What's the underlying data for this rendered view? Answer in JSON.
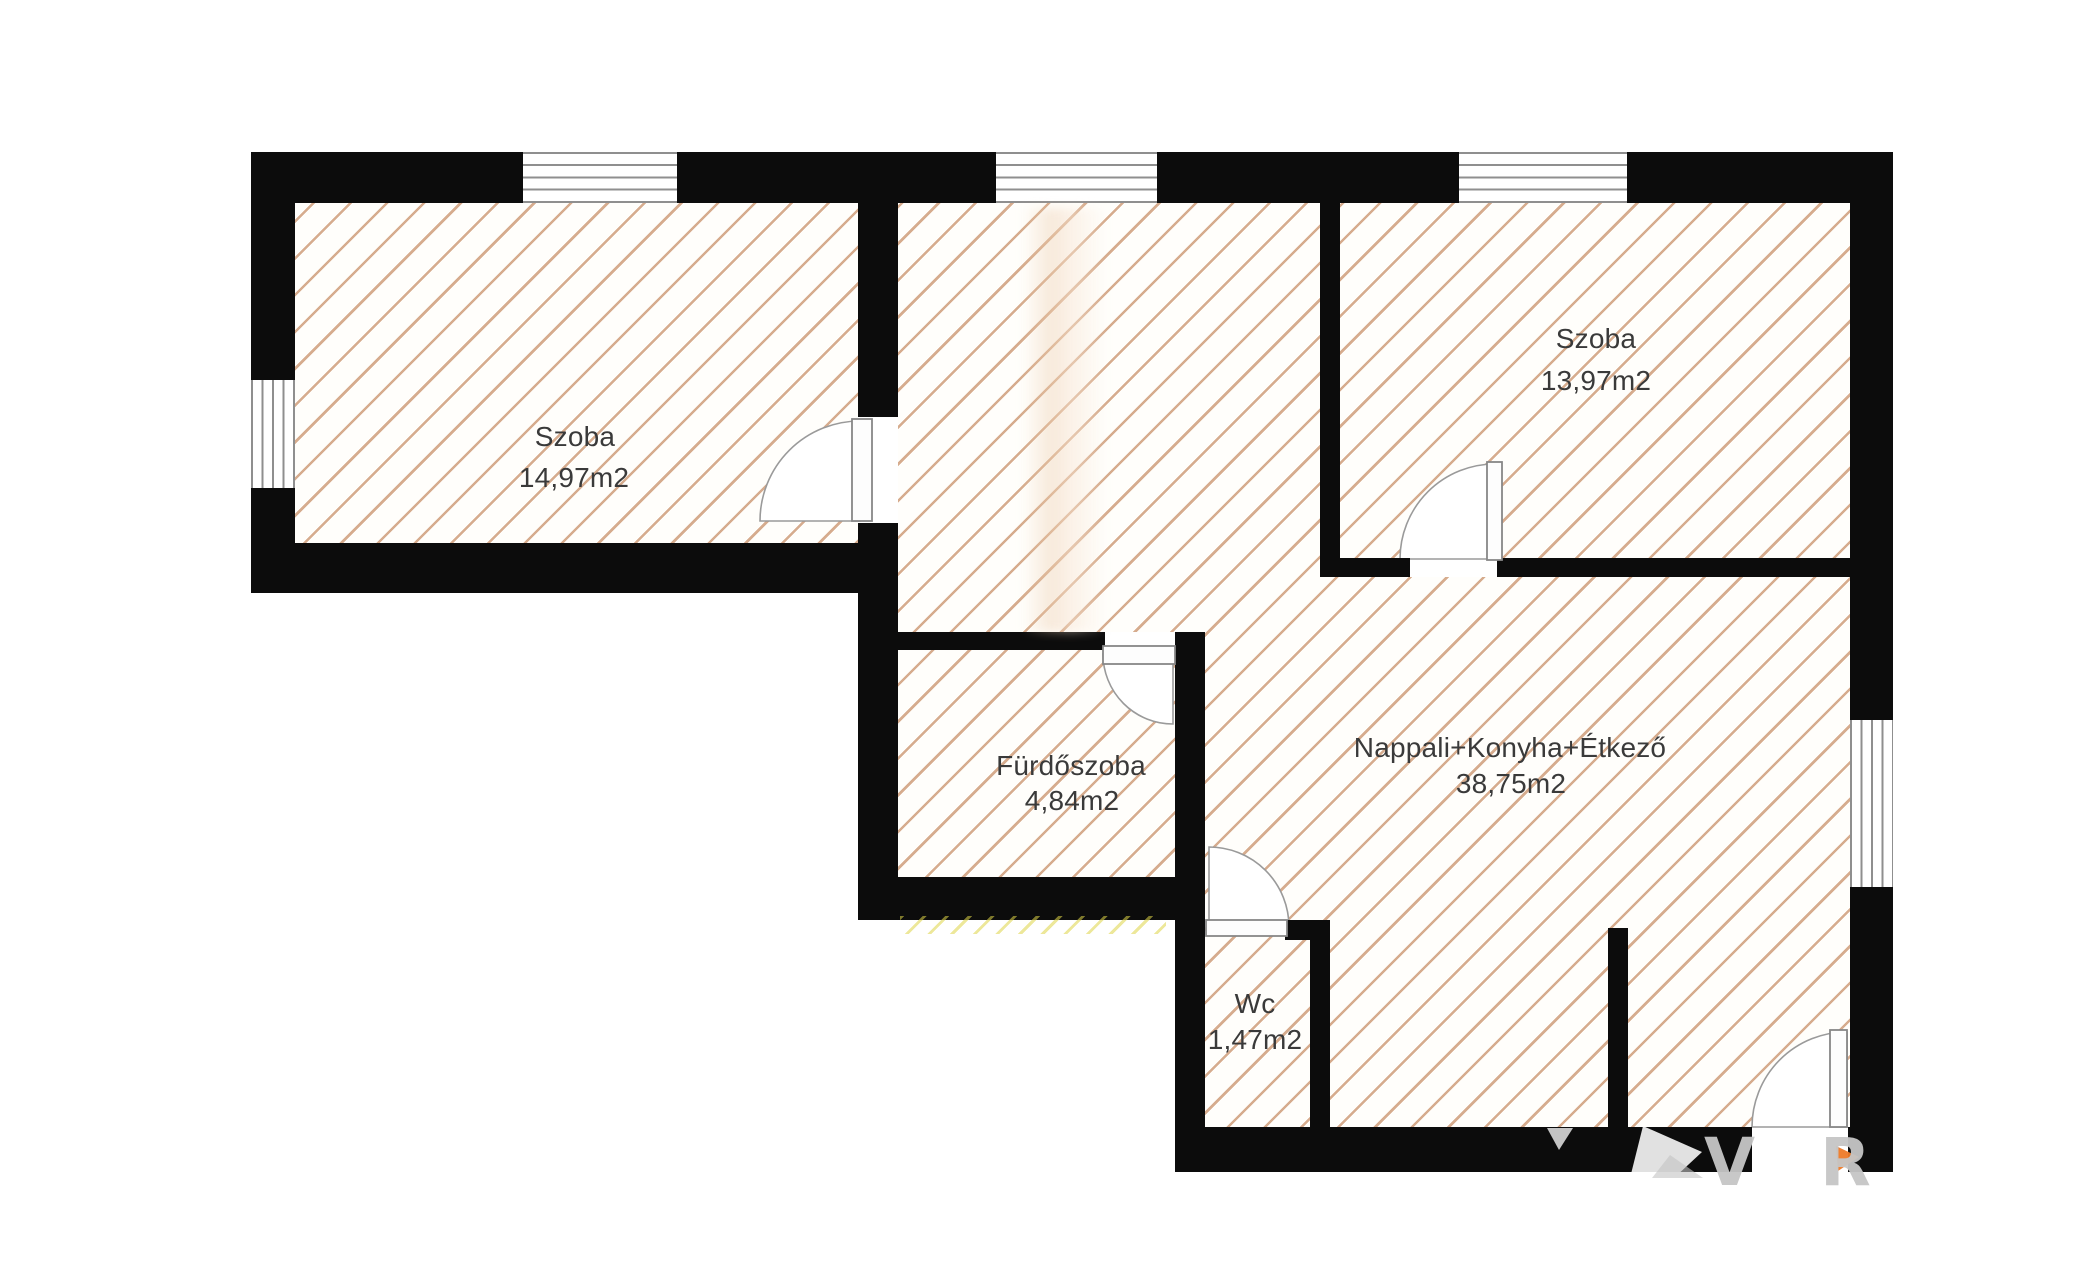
{
  "image_type": "floor-plan-drawing",
  "rooms": [
    {
      "name": "Szoba",
      "area": "14,97m2",
      "name_cx": 575,
      "name_cy": 437,
      "area_cx": 574,
      "area_cy": 478
    },
    {
      "name": "Szoba",
      "area": "13,97m2",
      "name_cx": 1596,
      "name_cy": 339,
      "area_cx": 1596,
      "area_cy": 381
    },
    {
      "name": "Fürdőszoba",
      "area": "4,84m2",
      "name_cx": 1071,
      "name_cy": 766,
      "area_cx": 1072,
      "area_cy": 801
    },
    {
      "name": "Nappali+Konyha+Étkező",
      "area": "38,75m2",
      "name_cx": 1510,
      "name_cy": 748,
      "area_cx": 1511,
      "area_cy": 784
    },
    {
      "name": "Wc",
      "area": "1,47m2",
      "name_cx": 1255,
      "name_cy": 1004,
      "area_cx": 1255,
      "area_cy": 1040
    }
  ],
  "watermark": {
    "letters": [
      {
        "glyph": "V",
        "x": 1704,
        "y": 1130
      },
      {
        "glyph": "R",
        "x": 1820,
        "y": 1130
      }
    ],
    "shapes": [
      {
        "name": "watermark-bird-body",
        "points": "1630,1178 1643,1126 1702,1152 1674,1178",
        "fill": "rgba(255,255,255,0.88)"
      },
      {
        "name": "watermark-bird-fold",
        "points": "1652,1178 1670,1155 1703,1178",
        "fill": "rgba(195,195,195,0.6)"
      },
      {
        "name": "watermark-small-mark",
        "points": "1547,1128 1573,1128 1559,1150",
        "fill": "rgba(216,216,216,0.9)"
      },
      {
        "name": "watermark-orange-accent",
        "points": "1836,1146 1859,1157 1838,1171",
        "fill": "rgba(238,122,40,0.95)"
      }
    ]
  },
  "colors": {
    "wall": "#0c0c0c",
    "hatch_line": "#c5895f",
    "floor_background": "#fffefb",
    "window_line": "#8f8f8f",
    "door_line": "#9a9a9a",
    "label_text": "#3a3a3a",
    "artifact_yellow": "#ded446",
    "watermark_gray": "#c6c6c6",
    "watermark_orange": "#ee7a28",
    "background": "#ffffff"
  },
  "floorplan": {
    "walls": [
      {
        "name": "wall-top-a",
        "x": 251,
        "y": 152,
        "w": 272,
        "h": 51
      },
      {
        "name": "wall-top-b",
        "x": 677,
        "y": 152,
        "w": 319,
        "h": 51
      },
      {
        "name": "wall-top-c",
        "x": 1157,
        "y": 152,
        "w": 302,
        "h": 51
      },
      {
        "name": "wall-top-d",
        "x": 1627,
        "y": 152,
        "w": 266,
        "h": 51
      },
      {
        "name": "wall-left-upper",
        "x": 251,
        "y": 152,
        "w": 44,
        "h": 228
      },
      {
        "name": "wall-left-lower",
        "x": 251,
        "y": 488,
        "w": 44,
        "h": 105
      },
      {
        "name": "wall-leftroom-bottom",
        "x": 251,
        "y": 543,
        "w": 647,
        "h": 50
      },
      {
        "name": "wall-corridor-left-upper",
        "x": 858,
        "y": 203,
        "w": 40,
        "h": 214
      },
      {
        "name": "wall-corridor-left-lower",
        "x": 858,
        "y": 523,
        "w": 40,
        "h": 397
      },
      {
        "name": "wall-bathroom-top",
        "x": 898,
        "y": 632,
        "w": 207,
        "h": 18
      },
      {
        "name": "wall-bathroom-top-corner",
        "x": 1175,
        "y": 632,
        "w": 30,
        "h": 18
      },
      {
        "name": "wall-bathroom-right",
        "x": 1175,
        "y": 632,
        "w": 30,
        "h": 495
      },
      {
        "name": "wall-bathroom-bottom",
        "x": 858,
        "y": 877,
        "w": 347,
        "h": 43
      },
      {
        "name": "wall-wc-top",
        "x": 1285,
        "y": 920,
        "w": 45,
        "h": 20
      },
      {
        "name": "wall-wc-right",
        "x": 1310,
        "y": 920,
        "w": 20,
        "h": 207
      },
      {
        "name": "wall-corridor-rightroom",
        "x": 1320,
        "y": 203,
        "w": 20,
        "h": 374
      },
      {
        "name": "wall-rightroom-bottom-a",
        "x": 1320,
        "y": 558,
        "w": 90,
        "h": 19
      },
      {
        "name": "wall-rightroom-bottom-b",
        "x": 1497,
        "y": 558,
        "w": 353,
        "h": 19
      },
      {
        "name": "wall-right-upper",
        "x": 1850,
        "y": 152,
        "w": 43,
        "h": 568
      },
      {
        "name": "wall-right-lower",
        "x": 1850,
        "y": 887,
        "w": 43,
        "h": 285
      },
      {
        "name": "wall-bottom-a",
        "x": 1175,
        "y": 1127,
        "w": 577,
        "h": 45
      },
      {
        "name": "wall-bottom-b",
        "x": 1848,
        "y": 1127,
        "w": 45,
        "h": 45
      },
      {
        "name": "wall-kitchen-stub",
        "x": 1608,
        "y": 928,
        "w": 20,
        "h": 199
      }
    ],
    "windows": [
      {
        "name": "window-top-left-room",
        "x": 523,
        "y": 152,
        "w": 154,
        "h": 51,
        "dir": "h"
      },
      {
        "name": "window-top-corridor",
        "x": 996,
        "y": 152,
        "w": 161,
        "h": 51,
        "dir": "h"
      },
      {
        "name": "window-top-right-room",
        "x": 1459,
        "y": 152,
        "w": 168,
        "h": 51,
        "dir": "h"
      },
      {
        "name": "window-left-wall",
        "x": 251,
        "y": 380,
        "w": 44,
        "h": 108,
        "dir": "v"
      },
      {
        "name": "window-right-wall",
        "x": 1850,
        "y": 720,
        "w": 43,
        "h": 167,
        "dir": "v"
      }
    ],
    "floors": [
      {
        "name": "floor-left-room",
        "x": 295,
        "y": 203,
        "w": 563,
        "h": 340
      },
      {
        "name": "floor-corridor",
        "x": 898,
        "y": 203,
        "w": 307,
        "h": 429
      },
      {
        "name": "floor-corridor-east",
        "x": 1205,
        "y": 203,
        "w": 115,
        "h": 374
      },
      {
        "name": "floor-bathroom",
        "x": 898,
        "y": 650,
        "w": 277,
        "h": 227
      },
      {
        "name": "floor-right-room",
        "x": 1340,
        "y": 203,
        "w": 510,
        "h": 355
      },
      {
        "name": "floor-living-room",
        "x": 1205,
        "y": 577,
        "w": 645,
        "h": 550
      },
      {
        "name": "floor-wc",
        "x": 1205,
        "y": 940,
        "w": 105,
        "h": 187
      }
    ],
    "doors": [
      {
        "name": "door-left-room",
        "pie": "M 860 521 L 860 421 A 100 100 0 0 0 760 521 Z",
        "leaf": {
          "x": 852,
          "y": 419,
          "w": 20,
          "h": 102
        }
      },
      {
        "name": "door-bathroom",
        "pie": "M 1173 654 L 1103 654 A 70 70 0 0 0 1173 724 Z",
        "leaf": {
          "x": 1103,
          "y": 646,
          "w": 72,
          "h": 18
        }
      },
      {
        "name": "door-right-room",
        "pie": "M 1495 559 L 1495 464 A 95 95 0 0 0 1400 559 Z",
        "leaf": {
          "x": 1487,
          "y": 462,
          "w": 15,
          "h": 98
        }
      },
      {
        "name": "door-wc",
        "pie": "M 1209 927 L 1209 847 A 80 80 0 0 1 1289 927 Z",
        "leaf": {
          "x": 1206,
          "y": 920,
          "w": 81,
          "h": 16
        }
      },
      {
        "name": "door-entry",
        "pie": "M 1847 1127 L 1752 1127 A 95 95 0 0 1 1847 1032 Z",
        "leaf": {
          "x": 1830,
          "y": 1030,
          "w": 17,
          "h": 97
        }
      }
    ]
  }
}
